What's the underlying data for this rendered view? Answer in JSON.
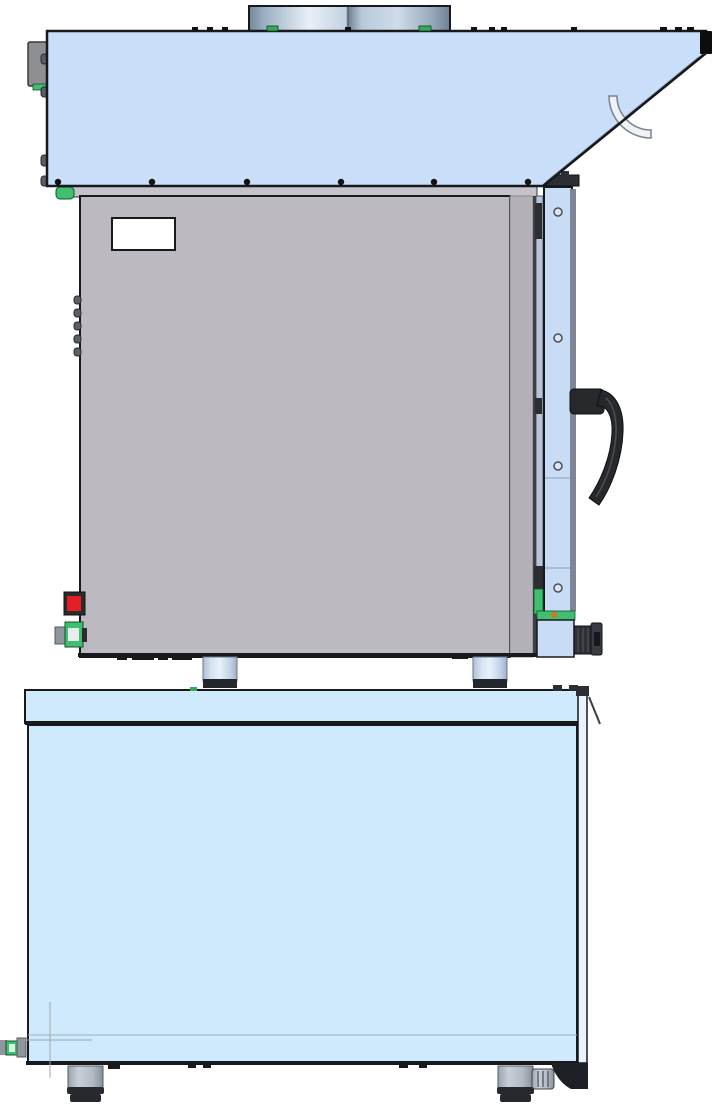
{
  "figure": {
    "kind": "cad-technical-drawing",
    "view": "side-elevation",
    "subject": "combi-oven with condensation hood stacked on base cabinet",
    "text_labels": [],
    "parts": [
      "vent-collar",
      "condensation-hood",
      "hood-junction-box",
      "hood-drain-handle",
      "oven-body",
      "rating-label",
      "door-hinge-column",
      "oven-door",
      "door-handle",
      "door-lower-hinge",
      "drain-knob",
      "red-button",
      "water-fitting",
      "stacking-leg-front",
      "stacking-leg-rear",
      "base-cabinet",
      "base-foot-front",
      "base-foot-rear",
      "base-caster-bracket",
      "base-drain-fitting",
      "centerline-marker"
    ]
  },
  "canvas": {
    "width": 716,
    "height": 1113,
    "background": "#ffffff"
  },
  "colors": {
    "outline": "#17191c",
    "hood": "#c9def8",
    "hood_slope_inner": "#8a9aad",
    "top_strip": "#c4c3c9",
    "oven": "#bcbac0",
    "oven_secondary": "#b3b1b7",
    "oven_edge": "#3c3f44",
    "frame_strip": "#b8c5d8",
    "door": "#c8dcf5",
    "door_edge": "#7d8694",
    "base": "#cfe9fd",
    "base_right": "#e9f3fd",
    "leg_dark": "#23262b",
    "foot": "#b7bec7",
    "foot_dark": "#26292e",
    "handle": "#26282c",
    "knob": "#2c3036",
    "metal": "#8f969e",
    "box_gray": "#8f8f93",
    "green": "#3fbf6f",
    "teal_tab": "#2fae57",
    "red": "#e31e24",
    "orange": "#c77a2a",
    "label": "#ffffff",
    "pipe": "#eef1f5",
    "pipe_stroke": "#7a828c",
    "crosshair": "#a0a5ab",
    "bump": "#5a5f66",
    "hinge_dark": "#2b2e33"
  }
}
